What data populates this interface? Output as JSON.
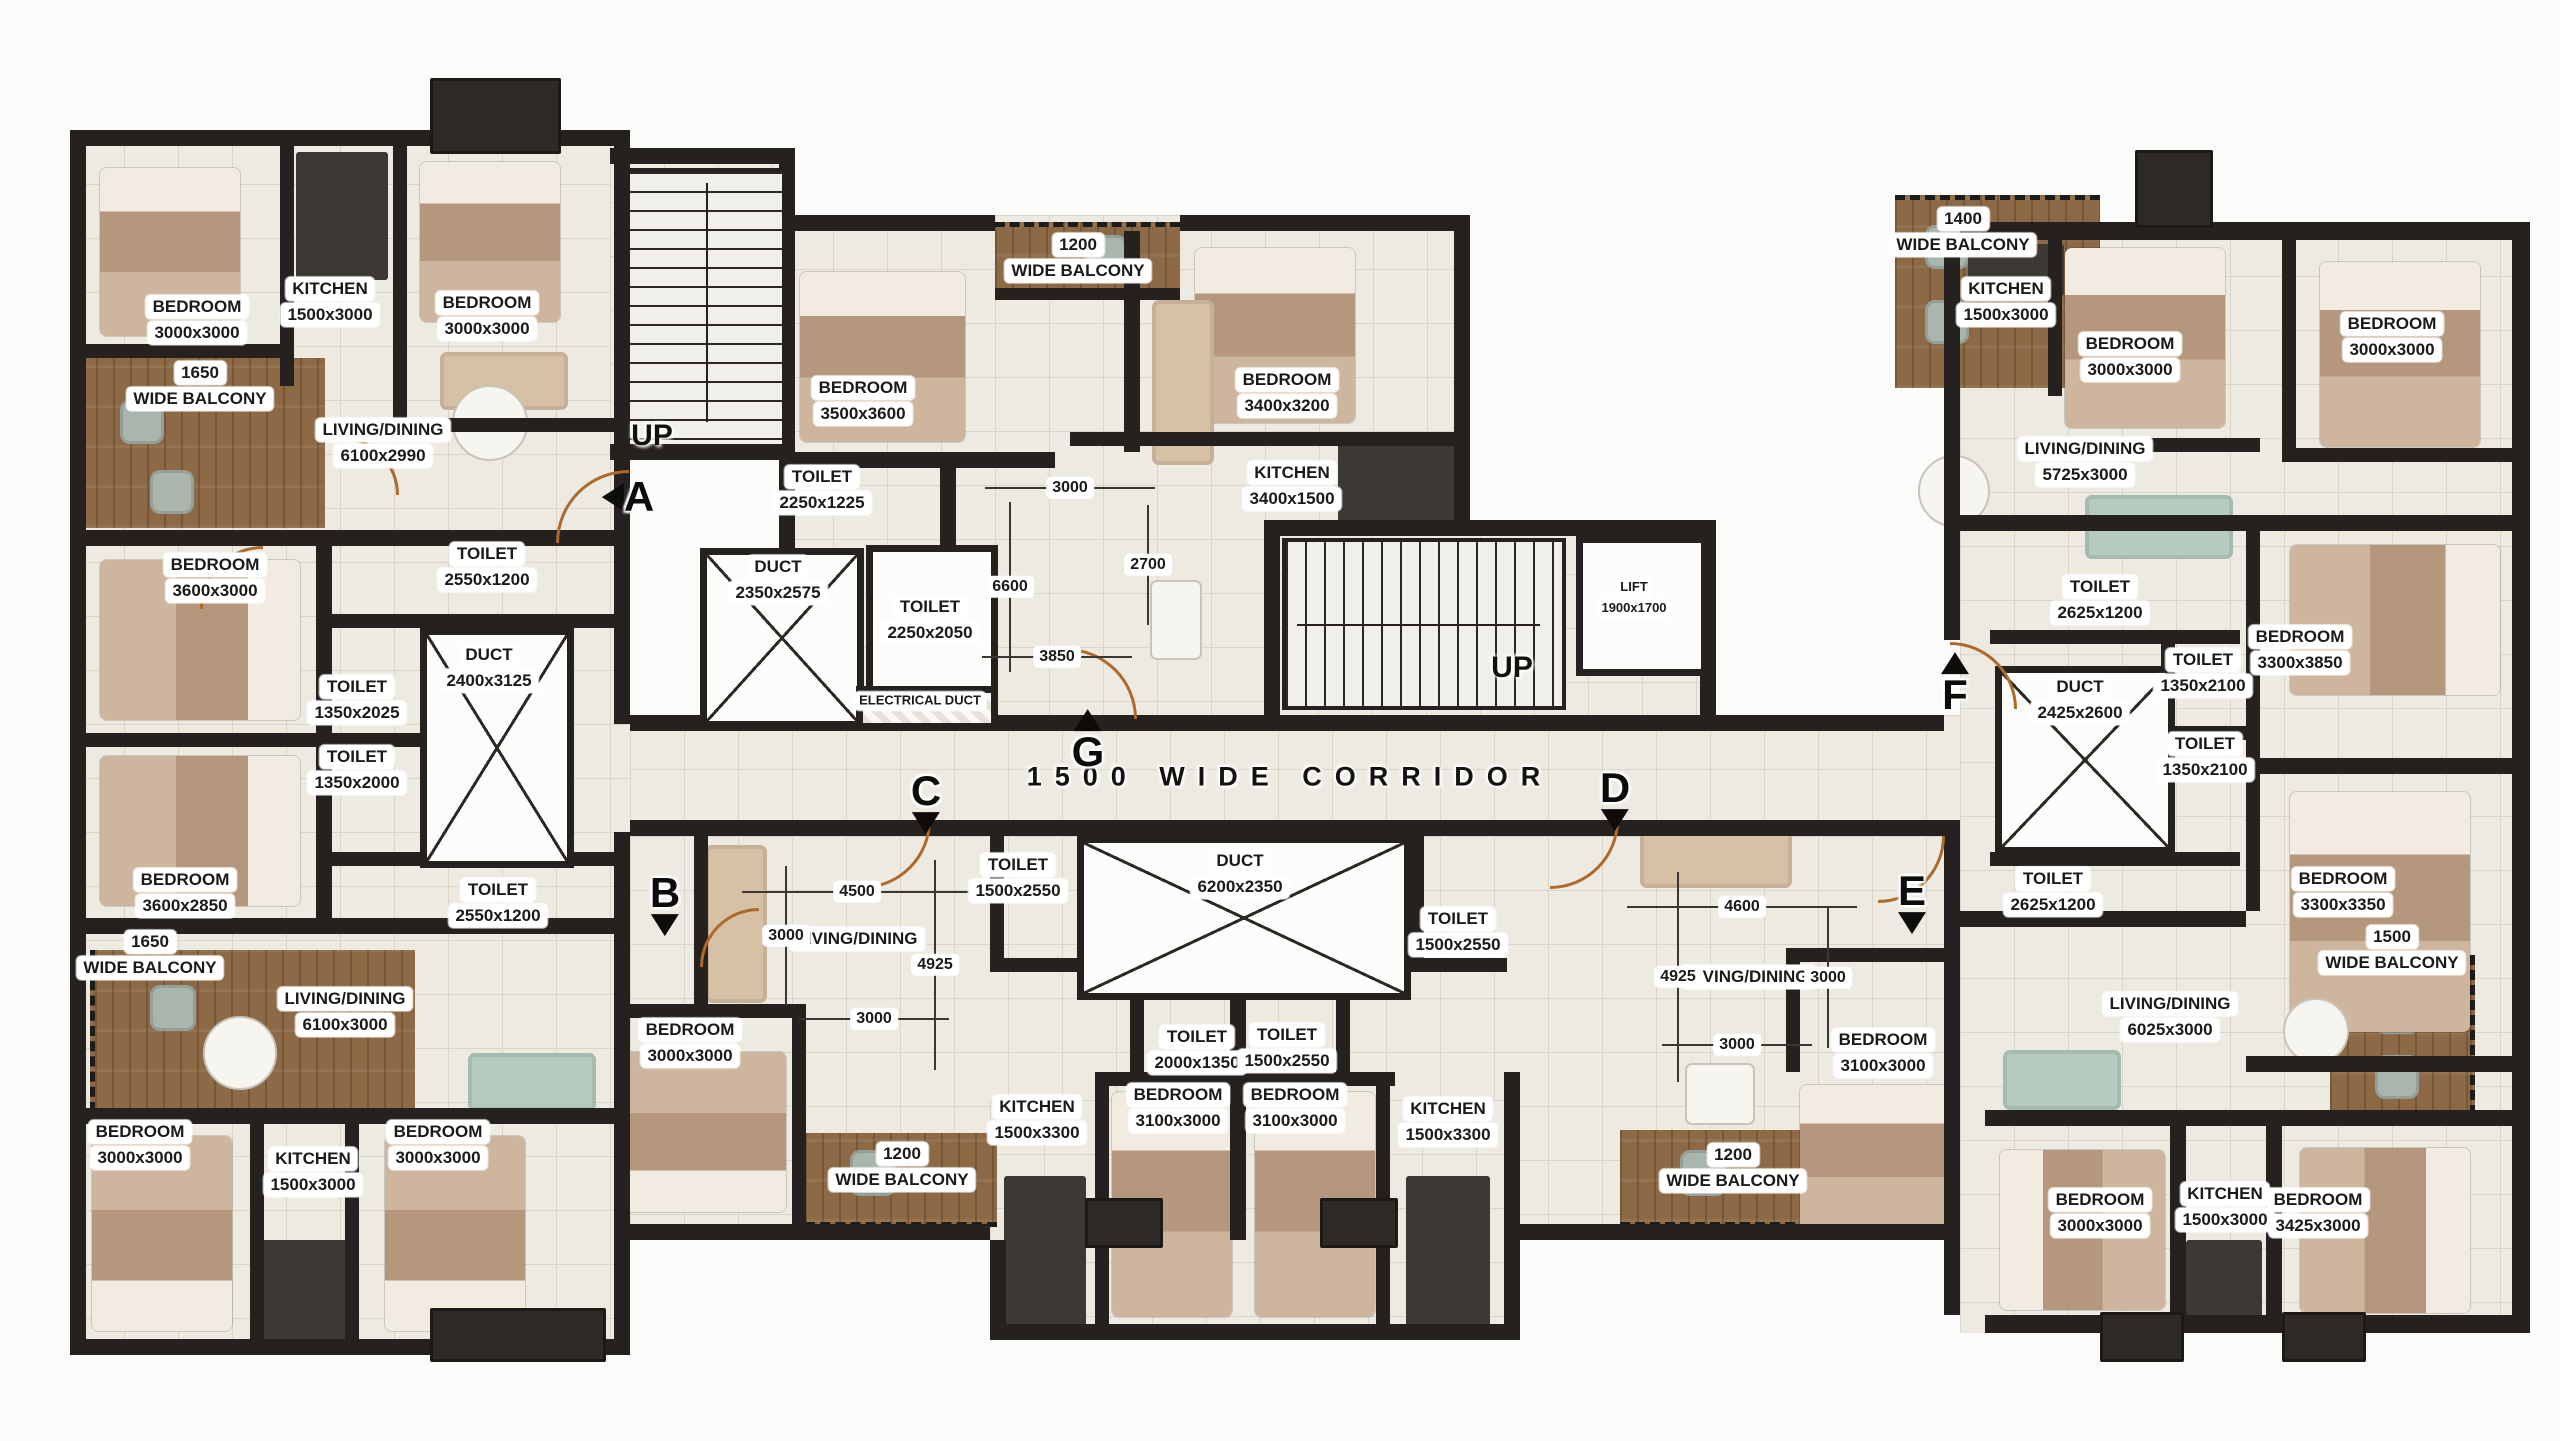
{
  "plan": {
    "corridor_text": "1500 WIDE CORRIDOR",
    "corridor_pos": {
      "x": 1290,
      "y": 777
    },
    "stair_labels": [
      {
        "text": "UP",
        "x": 652,
        "y": 436
      },
      {
        "text": "UP",
        "x": 1512,
        "y": 668
      }
    ],
    "rooms": [
      {
        "lines": [
          "BEDROOM",
          "3000x3000"
        ],
        "x": 197,
        "y": 320
      },
      {
        "lines": [
          "KITCHEN",
          "1500x3000"
        ],
        "x": 330,
        "y": 302
      },
      {
        "lines": [
          "BEDROOM",
          "3000x3000"
        ],
        "x": 487,
        "y": 316
      },
      {
        "lines": [
          "LIVING/DINING",
          "6100x2990"
        ],
        "x": 383,
        "y": 443
      },
      {
        "lines": [
          "1650",
          "WIDE BALCONY"
        ],
        "x": 200,
        "y": 386
      },
      {
        "lines": [
          "BEDROOM",
          "3600x3000"
        ],
        "x": 215,
        "y": 578
      },
      {
        "lines": [
          "TOILET",
          "2550x1200"
        ],
        "x": 487,
        "y": 567
      },
      {
        "lines": [
          "TOILET",
          "1350x2025"
        ],
        "x": 357,
        "y": 700
      },
      {
        "lines": [
          "DUCT",
          "2400x3125"
        ],
        "x": 489,
        "y": 668
      },
      {
        "lines": [
          "TOILET",
          "1350x2000"
        ],
        "x": 357,
        "y": 770
      },
      {
        "lines": [
          "BEDROOM",
          "3600x2850"
        ],
        "x": 185,
        "y": 893
      },
      {
        "lines": [
          "TOILET",
          "2550x1200"
        ],
        "x": 498,
        "y": 903
      },
      {
        "lines": [
          "1650",
          "WIDE BALCONY"
        ],
        "x": 150,
        "y": 955
      },
      {
        "lines": [
          "LIVING/DINING",
          "6100x3000"
        ],
        "x": 345,
        "y": 1012
      },
      {
        "lines": [
          "BEDROOM",
          "3000x3000"
        ],
        "x": 140,
        "y": 1145
      },
      {
        "lines": [
          "KITCHEN",
          "1500x3000"
        ],
        "x": 313,
        "y": 1172
      },
      {
        "lines": [
          "BEDROOM",
          "3000x3000"
        ],
        "x": 438,
        "y": 1145
      },
      {
        "lines": [
          "BEDROOM",
          "3000x3000"
        ],
        "x": 690,
        "y": 1043
      },
      {
        "lines": [
          "LIVING/DINING"
        ],
        "x": 857,
        "y": 939
      },
      {
        "lines": [
          "1200",
          "WIDE BALCONY"
        ],
        "x": 902,
        "y": 1167
      },
      {
        "lines": [
          "TOILET",
          "1500x2550"
        ],
        "x": 1018,
        "y": 878
      },
      {
        "lines": [
          "TOILET",
          "2000x1350"
        ],
        "x": 1197,
        "y": 1050
      },
      {
        "lines": [
          "KITCHEN",
          "1500x3300"
        ],
        "x": 1037,
        "y": 1120
      },
      {
        "lines": [
          "BEDROOM",
          "3100x3000"
        ],
        "x": 1178,
        "y": 1108
      },
      {
        "lines": [
          "DUCT",
          "6200x2350"
        ],
        "x": 1240,
        "y": 874
      },
      {
        "lines": [
          "TOILET",
          "1500x2550"
        ],
        "x": 1287,
        "y": 1048
      },
      {
        "lines": [
          "BEDROOM",
          "3100x3000"
        ],
        "x": 1295,
        "y": 1108
      },
      {
        "lines": [
          "TOILET",
          "1500x2550"
        ],
        "x": 1458,
        "y": 932
      },
      {
        "lines": [
          "KITCHEN",
          "1500x3300"
        ],
        "x": 1448,
        "y": 1122
      },
      {
        "lines": [
          "LIVING/DINING"
        ],
        "x": 1748,
        "y": 977
      },
      {
        "lines": [
          "1200",
          "WIDE BALCONY"
        ],
        "x": 1733,
        "y": 1168
      },
      {
        "lines": [
          "BEDROOM",
          "3100x3000"
        ],
        "x": 1883,
        "y": 1053
      },
      {
        "lines": [
          "BEDROOM",
          "3500x3600"
        ],
        "x": 863,
        "y": 401
      },
      {
        "lines": [
          "TOILET",
          "2250x1225"
        ],
        "x": 822,
        "y": 490
      },
      {
        "lines": [
          "DUCT",
          "2350x2575"
        ],
        "x": 778,
        "y": 580
      },
      {
        "lines": [
          "TOILET",
          "2250x2050"
        ],
        "x": 930,
        "y": 620
      },
      {
        "lines": [
          "ELECTRICAL DUCT"
        ],
        "x": 920,
        "y": 701,
        "size": "s"
      },
      {
        "lines": [
          "1200",
          "WIDE BALCONY"
        ],
        "x": 1078,
        "y": 258
      },
      {
        "lines": [
          "BEDROOM",
          "3400x3200"
        ],
        "x": 1287,
        "y": 393
      },
      {
        "lines": [
          "KITCHEN",
          "3400x1500"
        ],
        "x": 1292,
        "y": 486
      },
      {
        "lines": [
          "LIFT",
          "1900x1700"
        ],
        "x": 1634,
        "y": 598,
        "size": "s"
      },
      {
        "lines": [
          "1400",
          "WIDE BALCONY"
        ],
        "x": 1963,
        "y": 232
      },
      {
        "lines": [
          "KITCHEN",
          "1500x3000"
        ],
        "x": 2006,
        "y": 302
      },
      {
        "lines": [
          "BEDROOM",
          "3000x3000"
        ],
        "x": 2130,
        "y": 357
      },
      {
        "lines": [
          "BEDROOM",
          "3000x3000"
        ],
        "x": 2392,
        "y": 337
      },
      {
        "lines": [
          "LIVING/DINING",
          "5725x3000"
        ],
        "x": 2085,
        "y": 462
      },
      {
        "lines": [
          "TOILET",
          "2625x1200"
        ],
        "x": 2100,
        "y": 600
      },
      {
        "lines": [
          "TOILET",
          "1350x2100"
        ],
        "x": 2203,
        "y": 673
      },
      {
        "lines": [
          "DUCT",
          "2425x2600"
        ],
        "x": 2080,
        "y": 700
      },
      {
        "lines": [
          "TOILET",
          "1350x2100"
        ],
        "x": 2205,
        "y": 757
      },
      {
        "lines": [
          "BEDROOM",
          "3300x3850"
        ],
        "x": 2300,
        "y": 650
      },
      {
        "lines": [
          "TOILET",
          "2625x1200"
        ],
        "x": 2053,
        "y": 892
      },
      {
        "lines": [
          "BEDROOM",
          "3300x3350"
        ],
        "x": 2343,
        "y": 892
      },
      {
        "lines": [
          "LIVING/DINING",
          "6025x3000"
        ],
        "x": 2170,
        "y": 1017
      },
      {
        "lines": [
          "1500",
          "WIDE BALCONY"
        ],
        "x": 2392,
        "y": 950
      },
      {
        "lines": [
          "BEDROOM",
          "3000x3000"
        ],
        "x": 2100,
        "y": 1213
      },
      {
        "lines": [
          "KITCHEN",
          "1500x3000"
        ],
        "x": 2225,
        "y": 1207
      },
      {
        "lines": [
          "BEDROOM",
          "3425x3000"
        ],
        "x": 2318,
        "y": 1213
      }
    ],
    "dims": [
      {
        "text": "3000",
        "x": 1070,
        "y": 488,
        "axis": "h",
        "len": 170
      },
      {
        "text": "6600",
        "x": 1010,
        "y": 587,
        "axis": "v",
        "len": 170
      },
      {
        "text": "2700",
        "x": 1148,
        "y": 565,
        "axis": "v",
        "len": 120
      },
      {
        "text": "3850",
        "x": 1057,
        "y": 657,
        "axis": "h",
        "len": 150
      },
      {
        "text": "4500",
        "x": 857,
        "y": 892,
        "axis": "h",
        "len": 230
      },
      {
        "text": "3000",
        "x": 786,
        "y": 936,
        "axis": "v",
        "len": 140
      },
      {
        "text": "4925",
        "x": 935,
        "y": 965,
        "axis": "v",
        "len": 210
      },
      {
        "text": "3000",
        "x": 874,
        "y": 1019,
        "axis": "h",
        "len": 150
      },
      {
        "text": "4600",
        "x": 1742,
        "y": 907,
        "axis": "h",
        "len": 230
      },
      {
        "text": "4925",
        "x": 1678,
        "y": 977,
        "axis": "v",
        "len": 210
      },
      {
        "text": "3000",
        "x": 1828,
        "y": 978,
        "axis": "v",
        "len": 140
      },
      {
        "text": "3000",
        "x": 1737,
        "y": 1045,
        "axis": "h",
        "len": 150
      }
    ],
    "markers": [
      {
        "letter": "A",
        "x": 628,
        "y": 497,
        "dir": "left"
      },
      {
        "letter": "B",
        "x": 665,
        "y": 905,
        "dir": "down"
      },
      {
        "letter": "C",
        "x": 926,
        "y": 803,
        "dir": "down"
      },
      {
        "letter": "D",
        "x": 1615,
        "y": 800,
        "dir": "down"
      },
      {
        "letter": "E",
        "x": 1912,
        "y": 903,
        "dir": "down"
      },
      {
        "letter": "F",
        "x": 1955,
        "y": 683,
        "dir": "up"
      },
      {
        "letter": "G",
        "x": 1088,
        "y": 740,
        "dir": "up"
      }
    ],
    "colors": {
      "wall": "#24211e",
      "tile": "#edeae2",
      "tile_line": "#d9d5ca",
      "wood": "#8d6a45",
      "door": "#ad6a2b",
      "label_bg": "#ffffff",
      "label_text": "#1c1a17"
    }
  }
}
